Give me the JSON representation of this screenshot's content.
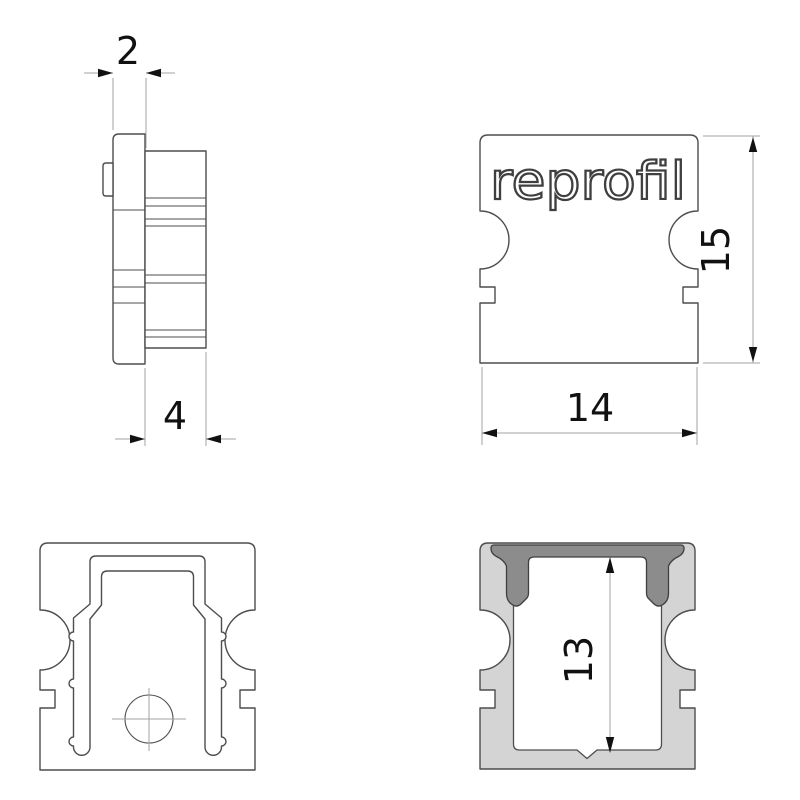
{
  "drawing": {
    "brand": "reprofil",
    "views": {
      "side": {
        "name": "side-view",
        "dims": {
          "cap_thickness": "2",
          "total_depth": "4"
        }
      },
      "front": {
        "name": "front-view",
        "logo_text": "reprofil",
        "dims": {
          "height": "15",
          "width": "14"
        }
      },
      "back": {
        "name": "back-view"
      },
      "section": {
        "name": "section-view",
        "dims": {
          "inner_height": "13"
        }
      }
    },
    "colors": {
      "background": "#ffffff",
      "outline": "#4d4d4d",
      "dim_line": "#a3a3a3",
      "dim_text": "#111111",
      "profile_fill": "#d4d4d4",
      "cover_fill": "#8c8c8c",
      "view_fill": "#ffffff"
    }
  }
}
